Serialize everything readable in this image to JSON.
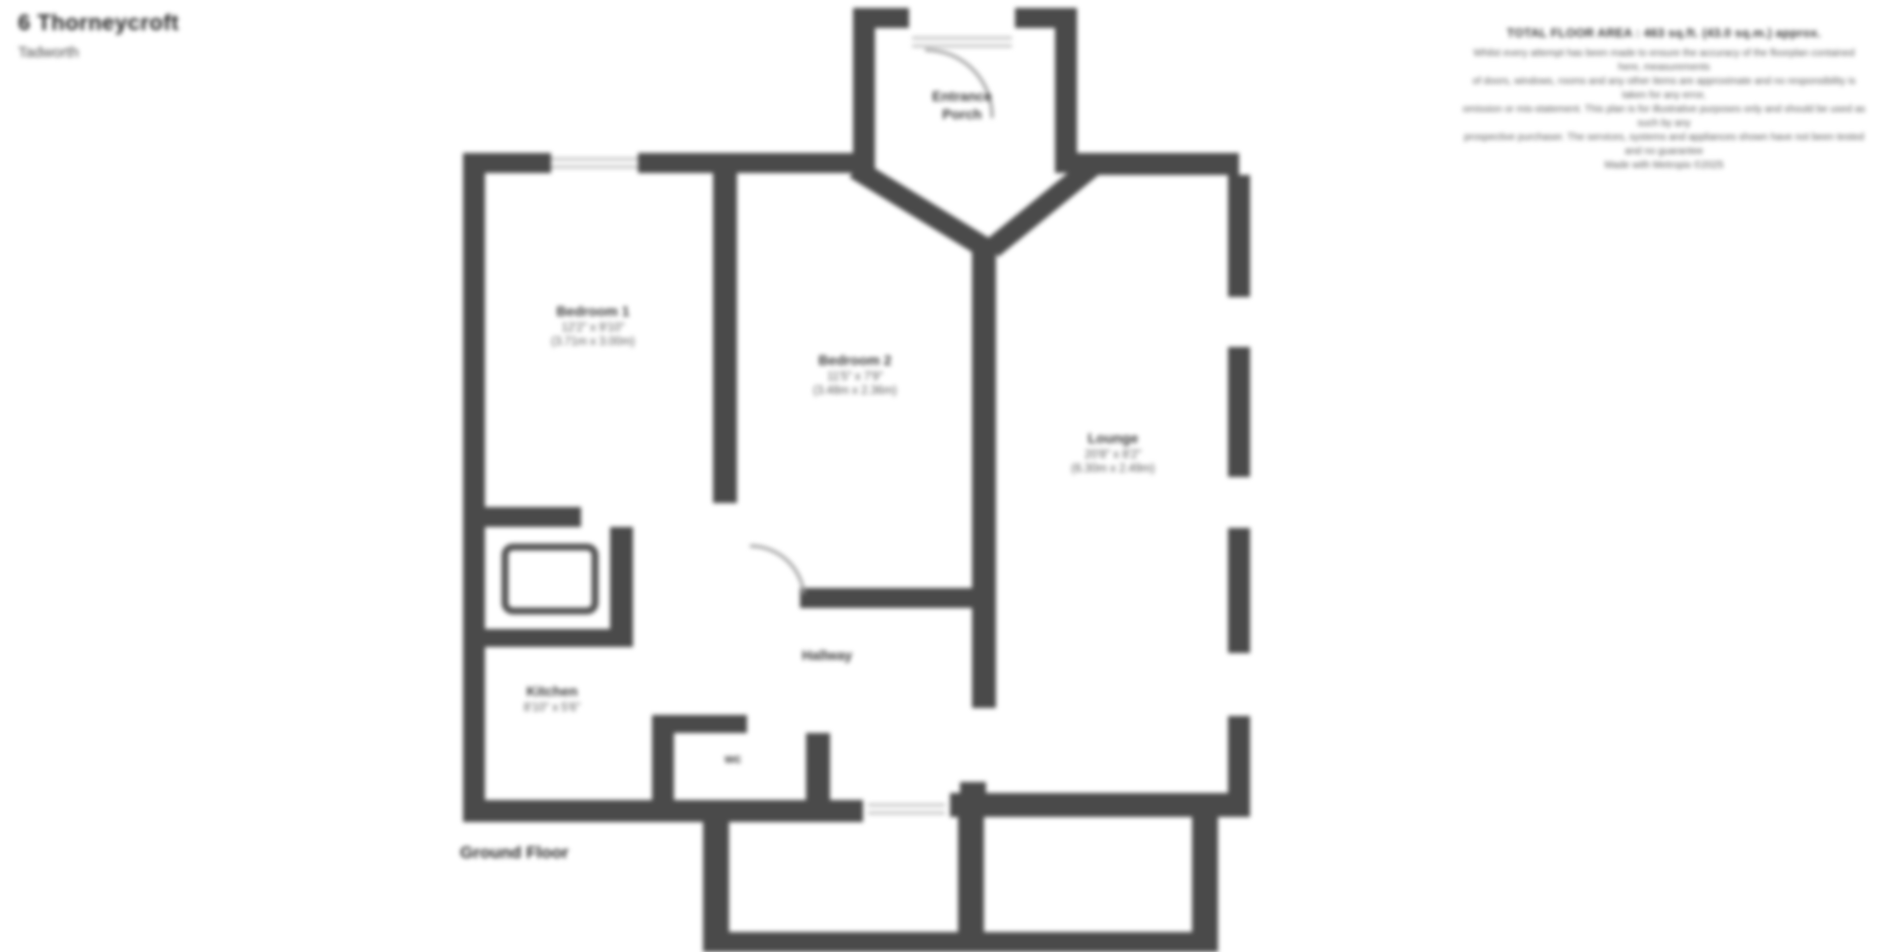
{
  "header": {
    "address_line1": "6 Thorneycroft",
    "address_line2": "Tadworth"
  },
  "plan": {
    "floor_label": "Ground Floor"
  },
  "rooms": {
    "porch": {
      "line1": "Entrance",
      "line2": "Porch"
    },
    "bedroom1": {
      "line1": "Bedroom 1",
      "line2": "12'2\" x 9'10\"",
      "line3": "(3.71m x 3.00m)"
    },
    "bedroom2": {
      "line1": "Bedroom 2",
      "line2": "11'5\" x 7'9\"",
      "line3": "(3.48m x 2.36m)"
    },
    "lounge": {
      "line1": "Lounge",
      "line2": "20'8\" x 8'2\"",
      "line3": "(6.30m x 2.49m)"
    },
    "kitchen": {
      "line1": "Kitchen",
      "line2": "8'10\" x 5'6\"",
      "line3": "(2.69m x 1.68m)"
    },
    "hallway": {
      "line1": "Hallway"
    },
    "wc": {
      "line1": "wc"
    }
  },
  "disclaimer": {
    "total_area": "TOTAL FLOOR AREA : 463 sq.ft. (43.0 sq.m.) approx.",
    "lines": [
      "Whilst every attempt has been made to ensure the accuracy of the floorplan contained here, measurements",
      "of doors, windows, rooms and any other items are approximate and no responsibility is taken for any error,",
      "omission or mis-statement. This plan is for illustrative purposes only and should be used as such by any",
      "prospective purchaser. The services, systems and appliances shown have not been tested and no guarantee"
    ],
    "attribution": "Made with Metropix ©2025"
  },
  "colors": {
    "wall": "#4a4a4a",
    "window": "#c4c4c4",
    "door_arc": "#9a9a9a",
    "text": "#2e2e2e"
  }
}
